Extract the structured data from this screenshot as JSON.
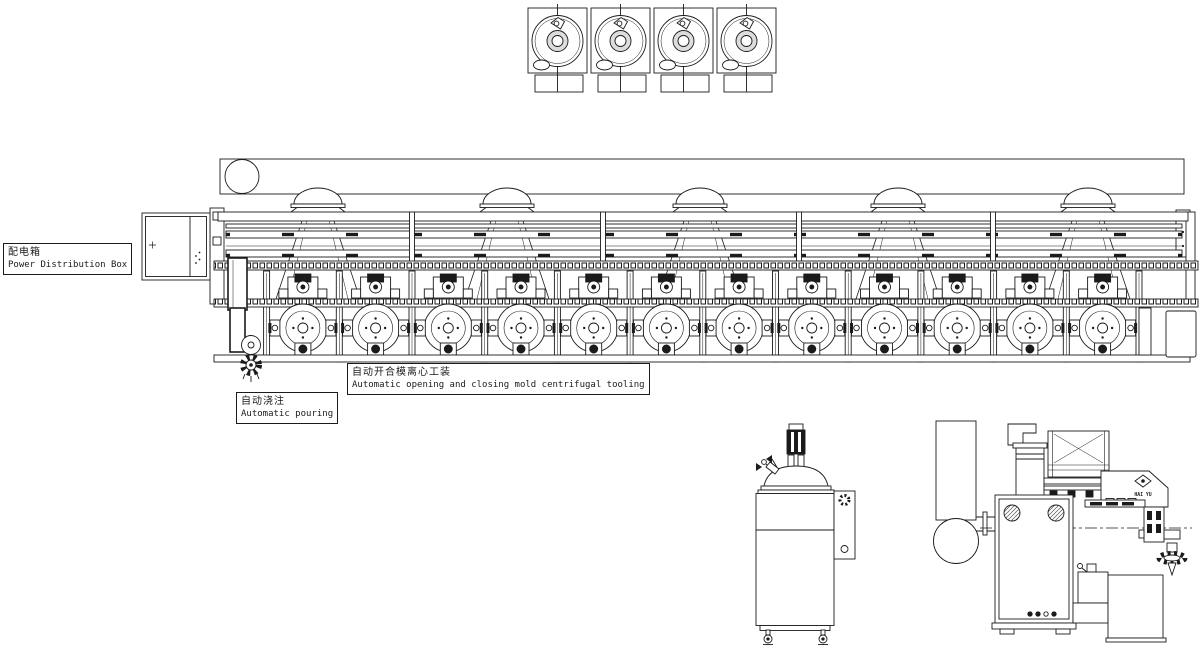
{
  "page": {
    "background": "#ffffff",
    "ink": "#1b1b1b"
  },
  "labels": {
    "power_box": {
      "zh": "配电箱",
      "en": "Power Distribution Box"
    },
    "tooling": {
      "zh": "自动开合模离心工装",
      "en": "Automatic opening and closing mold centrifugal tooling"
    },
    "pouring": {
      "zh": "自动浇注",
      "en": "Automatic pouring"
    }
  },
  "machine": {
    "brand": "HAI YU",
    "station_count": 12,
    "top_unit_count": 4,
    "dome_count": 5,
    "top_unit_x": [
      528,
      591,
      654,
      717
    ],
    "dome_x": [
      318,
      507,
      700,
      898,
      1088
    ],
    "upper_post_x": [
      412,
      603,
      799,
      993
    ],
    "cell_boundary_x": [
      266.6,
      339.3,
      412,
      484.7,
      557.4,
      630.1,
      702.8,
      775.5,
      848.2,
      920.9,
      993.6,
      1066.3,
      1139
    ],
    "station_x": [
      302.9,
      375.6,
      448.3,
      521,
      593.7,
      666.4,
      739.1,
      811.8,
      884.5,
      957.2,
      1029.9,
      1102.6
    ]
  }
}
